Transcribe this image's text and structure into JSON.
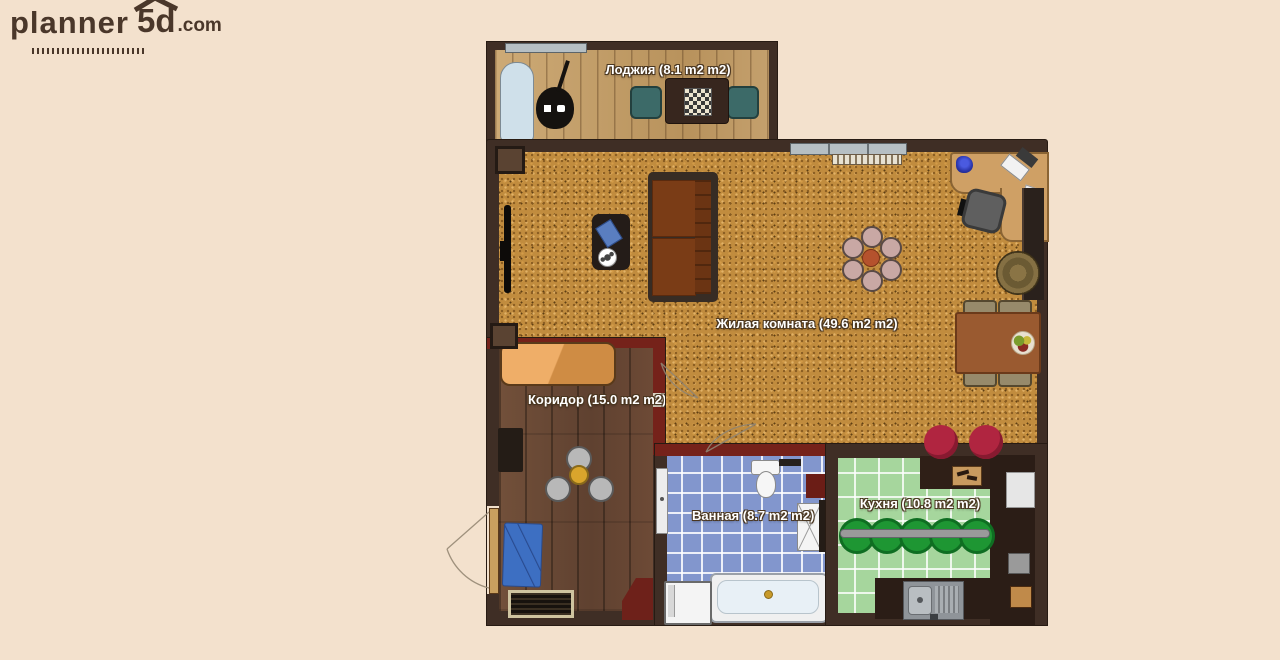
{
  "logo": {
    "brand": "planner",
    "suffix": "5d",
    "tld": ".com"
  },
  "rooms": {
    "loggia": {
      "label": "Лоджия (8.1 m2 m2)",
      "area_m2": 8.1
    },
    "living": {
      "label": "Жилая комната (49.6 m2 m2)",
      "area_m2": 49.6
    },
    "corridor": {
      "label": "Коридор (15.0 m2 m2)",
      "area_m2": 15.0
    },
    "bathroom": {
      "label": "Ванная (8.7 m2 m2)",
      "area_m2": 8.7
    },
    "kitchen": {
      "label": "Кухня (10.8 m2 m2)",
      "area_m2": 10.8
    }
  },
  "furniture": {
    "loggia": [
      "ironing-board",
      "vacuum-cleaner",
      "chess-table",
      "chair",
      "chair"
    ],
    "living": [
      "window",
      "radiator",
      "wall-tv",
      "sofa",
      "coffee-table",
      "book",
      "soccer-ball",
      "ceiling-lamp",
      "desk",
      "vase",
      "computer-monitor",
      "computer-tower",
      "mouse",
      "office-chair",
      "wall-cabinet",
      "floor-barrel",
      "dining-table",
      "dining-chair",
      "dining-chair",
      "dining-chair",
      "dining-chair",
      "fruit-bowl",
      "red-stool",
      "red-stool"
    ],
    "corridor": [
      "wardrobe",
      "wall-cabinet",
      "chandelier",
      "blue-rug",
      "entry-door",
      "slatted-bench",
      "corner-cabinet"
    ],
    "bathroom": [
      "door",
      "toilet",
      "towel-rail",
      "wall-cabinet",
      "sink",
      "bathtub",
      "washing-machine"
    ],
    "kitchen": [
      "counter",
      "cutting-board",
      "refrigerator",
      "stool-rail",
      "green-stool",
      "green-stool",
      "green-stool",
      "green-stool",
      "green-stool",
      "kitchen-sink",
      "small-appliance",
      "wall-item"
    ]
  },
  "colors": {
    "background": "#f3e1cd",
    "outer_wall": "#3f2e25",
    "inner_wall": "#75221a",
    "carpet": "#c18c3e",
    "loggia_floor": "#c4a06d",
    "corridor_floor": "#6d4a36",
    "bathroom_tile": "#8296cd",
    "kitchen_tile": "#a6d69d",
    "label_text": "#ffffff",
    "logo_text": "#4a372a"
  }
}
